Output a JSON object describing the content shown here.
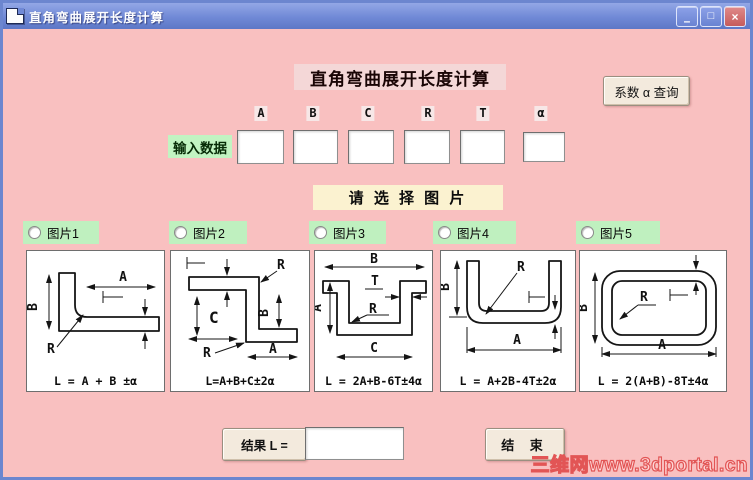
{
  "window": {
    "title": "直角弯曲展开长度计算",
    "controls": {
      "minimize": "–",
      "maximize": "□",
      "close": "×"
    }
  },
  "header": {
    "title": "直角弯曲展开长度计算",
    "coefficient_query_button": "系数 α 查询"
  },
  "input_section": {
    "label": "输入数据",
    "fields": [
      {
        "label": "A",
        "value": ""
      },
      {
        "label": "B",
        "value": ""
      },
      {
        "label": "C",
        "value": ""
      },
      {
        "label": "R",
        "value": ""
      },
      {
        "label": "T",
        "value": ""
      },
      {
        "label": "α",
        "value": ""
      }
    ]
  },
  "picker": {
    "prompt": "请 选 择 图 片",
    "options": [
      {
        "label": "图片1",
        "formula": "L = A + B ±α"
      },
      {
        "label": "图片2",
        "formula": "L=A+B+C±2α"
      },
      {
        "label": "图片3",
        "formula": "L = 2A+B-6T±4α"
      },
      {
        "label": "图片4",
        "formula": "L = A+2B-4T±2α"
      },
      {
        "label": "图片5",
        "formula": "L = 2(A+B)-8T±4α"
      }
    ]
  },
  "dims": {
    "A": "A",
    "B": "B",
    "C": "C",
    "R": "R",
    "T": "T"
  },
  "result": {
    "label": "结果 L =",
    "value": "",
    "end_button": "结 束"
  },
  "watermark": {
    "text": "三维网www.3dportal.cn"
  },
  "colors": {
    "titlebar": "#6c86cf",
    "body": "#f9c0c0",
    "label_green": "#c2f4c2",
    "radio_green": "#bff0bf",
    "prompt_cream": "#fbf2d0",
    "button_face": "#f3eadd",
    "watermark_red": "#e25555"
  }
}
